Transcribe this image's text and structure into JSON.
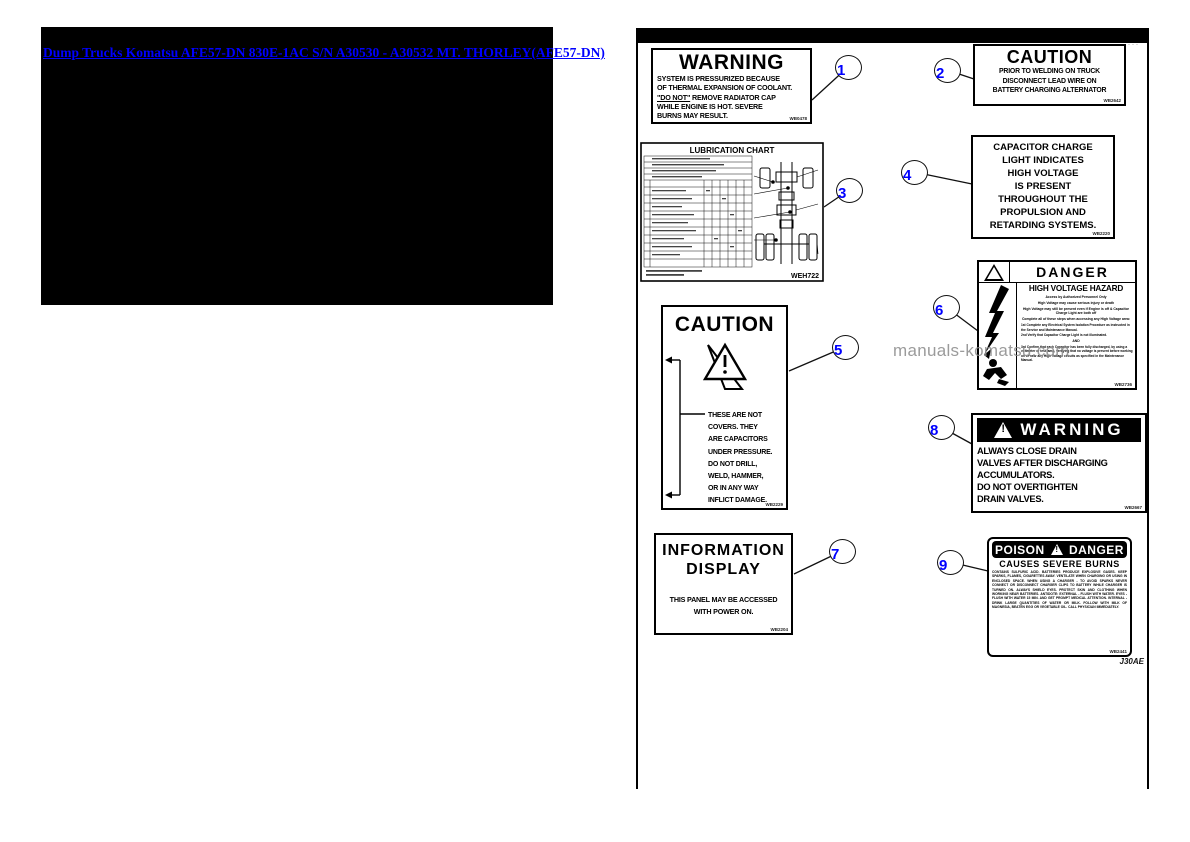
{
  "colors": {
    "link-blue": "#0000ff",
    "callout-blue": "#0000ff",
    "watermark-gray": "#8a8a8a"
  },
  "page": {
    "breadcrumb_link": "Dump Trucks Komatsu AFE57-DN 830E-1AC S/N A30530 - A30532 MT. THORLEY(AFE57-DN)",
    "watermark": "manuals-komatsu.com",
    "sheet_code": "J30AE",
    "tick_marks": "·····"
  },
  "callouts": [
    "1",
    "2",
    "3",
    "4",
    "5",
    "6",
    "7",
    "8",
    "9"
  ],
  "labels": {
    "warning_radiator": {
      "title": "WARNING",
      "line1": "SYSTEM IS PRESSURIZED BECAUSE",
      "line2": "OF THERMAL EXPANSION OF COOLANT.",
      "line3_u": "\"DO NOT\"",
      "line3_rest": " REMOVE RADIATOR CAP",
      "line4": "WHILE ENGINE IS HOT. SEVERE",
      "line5": "BURNS MAY RESULT.",
      "code": "WB0478"
    },
    "caution_welding": {
      "title": "CAUTION",
      "line1": "PRIOR TO WELDING ON TRUCK",
      "line2": "DISCONNECT LEAD WIRE ON",
      "line3": "BATTERY CHARGING ALTERNATOR",
      "code": "WB2642"
    },
    "lubrication_chart": {
      "title": "LUBRICATION CHART",
      "code": "WEH722"
    },
    "capacitor_charge": {
      "line1": "CAPACITOR CHARGE",
      "line2": "LIGHT INDICATES",
      "line3": "HIGH VOLTAGE",
      "line4": "IS PRESENT",
      "line5": "THROUGHOUT THE",
      "line6": "PROPULSION AND",
      "line7": "RETARDING SYSTEMS.",
      "code": "WB2220"
    },
    "caution_capacitors": {
      "title": "CAUTION",
      "line1": "THESE ARE NOT",
      "line2": "COVERS. THEY",
      "line3": "ARE CAPACITORS",
      "line4": "UNDER PRESSURE.",
      "line5": "DO NOT DRILL,",
      "line6": "WELD, HAMMER,",
      "line7": "OR IN ANY WAY",
      "line8": "INFLICT DAMAGE.",
      "code": "WB2229"
    },
    "danger_high_voltage": {
      "title": "DANGER",
      "heading": "HIGH VOLTAGE HAZARD",
      "sub1": "Access by Authorized Personnel Only",
      "sub2": "High Voltage may cause serious injury or death",
      "para1": "High Voltage may still be present even if Engine is off & Capacitor Charge Light are both off",
      "para2": "Complete all of these steps when accessing any High Voltage area:",
      "item1": "1st   Complete any Electrical System Isolation Procedure as instructed in the Service and Maintenance Manual.",
      "item2": "2nd   Verify that Capacitor Charge Light is not illuminated.",
      "and": "AND",
      "item3": "3rd   Confirm that each Capacitor has been fully discharged, by using a voltmeter or test lamp, verifying that no voltage is present before working on or near any High Voltage circuits as specified in the Maintenance Manual.",
      "code": "WB2736"
    },
    "information_display": {
      "title1": "INFORMATION",
      "title2": "DISPLAY",
      "line1": "THIS PANEL MAY BE ACCESSED",
      "line2": "WITH POWER ON.",
      "code": "WB2204"
    },
    "warning_drain_valves": {
      "title": "WARNING",
      "line1": "ALWAYS CLOSE DRAIN",
      "line2": "VALVES AFTER DISCHARGING",
      "line3": "ACCUMULATORS.",
      "line4": "DO NOT OVERTIGHTEN",
      "line5": "DRAIN VALVES.",
      "code": "WB2667"
    },
    "poison_danger": {
      "title_left": "POISON",
      "title_right": "DANGER",
      "subtitle": "CAUSES SEVERE BURNS",
      "body": "CONTAINS SULFURIC ACID. BATTERIES PRODUCE EXPLOSIVE GASES. KEEP SPARKS, FLAMES, CIGARETTES AWAY. VENTILATE WHEN CHARGING OR USING IN ENCLOSED SPACE. WHEN USING A CHARGER - TO AVOID SPARKS NEVER CONNECT OR DISCONNECT CHARGER CLIPS TO BATTERY WHILE CHARGER IS TURNED ON. ALWAYS SHIELD EYES. PROTECT SKIN AND CLOTHING WHEN WORKING NEAR BATTERIES. ANTIDOTE: EXTERNAL - FLUSH WITH WATER. EYES - FLUSH WITH WATER 15 MIN. AND GET PROMPT MEDICAL ATTENTION. INTERNAL - DRINK LARGE QUANTITIES OF WATER OR MILK. FOLLOW WITH MILK OF MAGNESIA, BEATEN EGG OR VEGETABLE OIL. CALL PHYSICIAN IMMEDIATELY.",
      "code": "WB2441"
    }
  }
}
